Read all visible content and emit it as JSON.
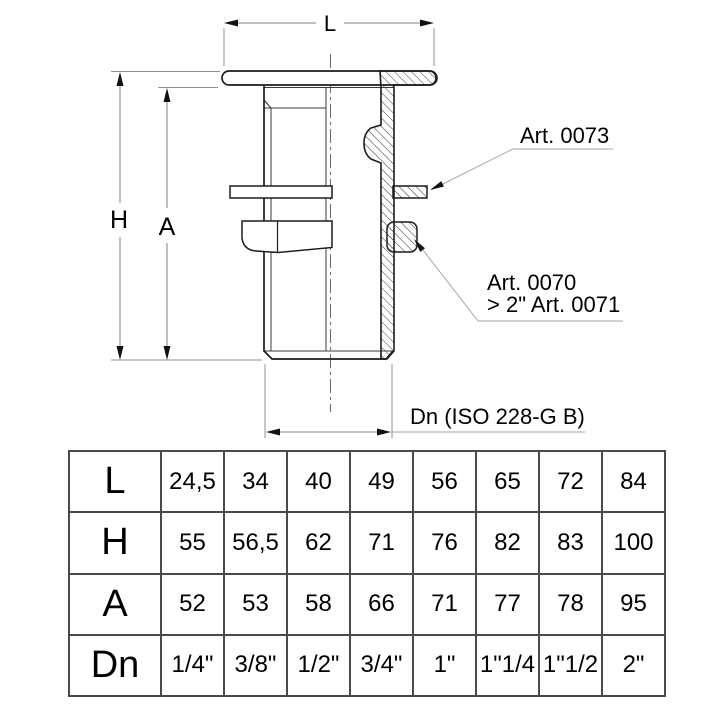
{
  "drawing": {
    "dim_l_label": "L",
    "dim_h_label": "H",
    "dim_a_label": "A",
    "callout_washer": "Art. 0073",
    "callout_nut_line1": "Art. 0070",
    "callout_nut_line2": "> 2\" Art. 0071",
    "thread_label": "Dn (ISO 228-G B)"
  },
  "table": {
    "rows": [
      {
        "label": "L",
        "values": [
          "24,5",
          "34",
          "40",
          "49",
          "56",
          "65",
          "72",
          "84"
        ]
      },
      {
        "label": "H",
        "values": [
          "55",
          "56,5",
          "62",
          "71",
          "76",
          "82",
          "83",
          "100"
        ]
      },
      {
        "label": "A",
        "values": [
          "52",
          "53",
          "58",
          "66",
          "71",
          "77",
          "78",
          "95"
        ]
      },
      {
        "label": "Dn",
        "values": [
          "1/4\"",
          "3/8\"",
          "1/2\"",
          "3/4\"",
          "1\"",
          "1\"1/4",
          "1\"1/2",
          "2\""
        ]
      }
    ]
  },
  "colors": {
    "outline": "#1c1c1c",
    "dimension": "#808080",
    "leader": "#a6a6a6",
    "text": "#000000",
    "background": "#ffffff"
  }
}
